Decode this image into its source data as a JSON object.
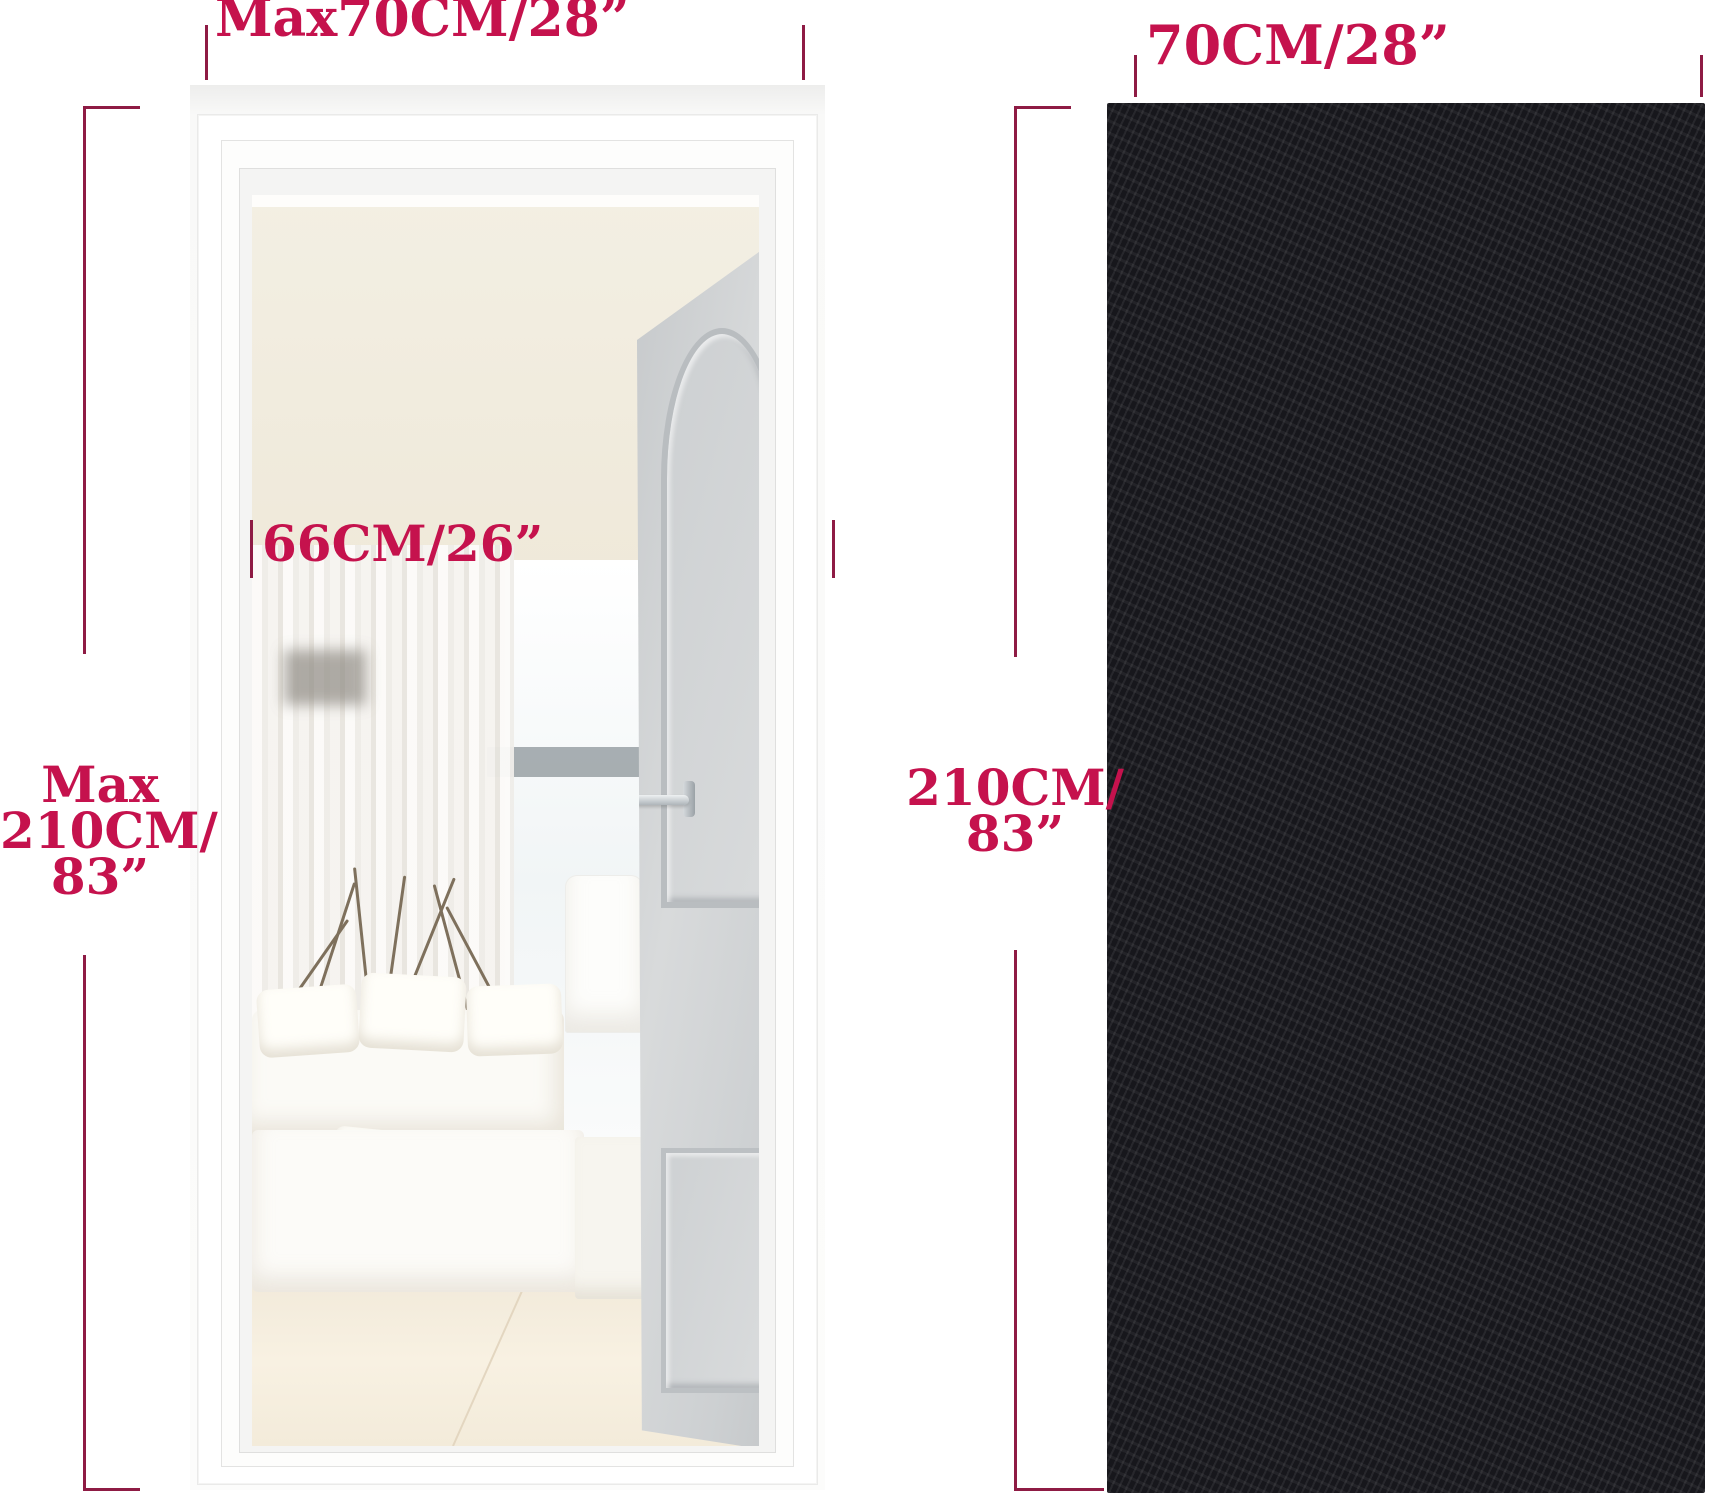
{
  "colors": {
    "dimension_text": "#c5124d",
    "dimension_line": "#8e1b44",
    "mesh_frame_black": "#17171c",
    "mesh_fabric": "#e7e2d8",
    "door_grey": "#d0d3d5"
  },
  "left_figure": {
    "description": "open doorway photo with measurement brackets",
    "top_width_label": "Max70CM/28”",
    "inner_width_label": "66CM/26”",
    "height_label": {
      "line1": "Max",
      "line2": "210CM/",
      "line3": "83”"
    }
  },
  "right_figure": {
    "description": "magnetic mesh screen door product photo",
    "top_width_label": "70CM/28”",
    "height_label": {
      "line1": "210CM/",
      "line2": "83”"
    }
  },
  "measurements": {
    "door_frame_max_width": "Max 70 CM / 28 in",
    "door_frame_max_height": "Max 210 CM / 83 in",
    "door_opening_width": "66 CM / 26 in",
    "screen_width": "70 CM / 28 in",
    "screen_height": "210 CM / 83 in"
  }
}
